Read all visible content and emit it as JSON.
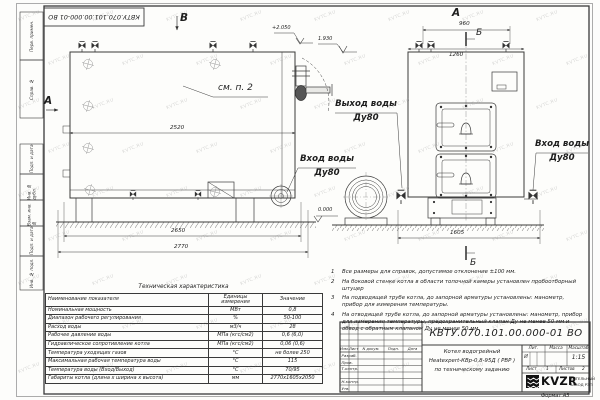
{
  "sheet": {
    "stamp_top": "КВТУ.070.101.00.000-01  ВО",
    "format_note": "Формат  А3",
    "watermark": "KVTC.RU",
    "side_labels": [
      "Перв. примен.",
      "Справ. №",
      "Подп. и дата",
      "Инв. № дубл.",
      "Взам. инв. №",
      "Подп. и дата",
      "Инв. № подл."
    ]
  },
  "views": {
    "side": {
      "view_mark_top": "В",
      "view_mark_left": "А",
      "see_note": "см. п. 2",
      "elev_top": "+2.050",
      "elev_outlet": "1.930",
      "elev_zero": "0.000",
      "dim_body": "2520",
      "dim_mid": "2650",
      "dim_overall": "2770",
      "outlet_line1": "Выход воды",
      "outlet_line2": "Ду80",
      "inlet_line1": "Вход воды",
      "inlet_line2": "Ду80"
    },
    "front": {
      "view_mark": "А",
      "section_mark_top": "Б",
      "section_mark_bottom": "Б",
      "dim_top": "960",
      "dim_body": "1260",
      "dim_base": "1605",
      "inlet_line1": "Вход воды",
      "inlet_line2": "Ду80"
    }
  },
  "notes": [
    {
      "num": "1",
      "text": "Все размеры для справок, допустимое отклонение ±100 мм."
    },
    {
      "num": "2",
      "text": "На боковой стенке котла в области топочной камеры установлен пробоотборный штуцер"
    },
    {
      "num": "3",
      "text": "На подводящей трубе котла, до запорной арматуры установлены: манометр, прибор для измерения температуры."
    },
    {
      "num": "4",
      "text": "На отводящей трубе котла, до запорной арматуры установлены: манометр, прибор для измерения температуры, предохранительный клапан Ду не менее 50 мм и обвод с обратным клапаном Ду не менее 50 мм."
    }
  ],
  "spec_table": {
    "title": "Техническая характеристика",
    "col_name": "Наименование показателя",
    "col_units": "Единицы измерения",
    "col_value": "Значение",
    "rows": [
      [
        "Номинальная мощность",
        "МВт",
        "0,8"
      ],
      [
        "Диапазон рабочего регулирования",
        "%",
        "50-100"
      ],
      [
        "Расход воды",
        "м3/ч",
        "28"
      ],
      [
        "Рабочее давление воды",
        "МПа (кгс/см2)",
        "0,6 (6,0)"
      ],
      [
        "Гидравлическое сопротивление котла",
        "МПа (кгс/см2)",
        "0,06 (0,6)"
      ],
      [
        "Температура уходящих газов",
        "°С",
        "не более 250"
      ],
      [
        "Максимальная рабочая температура воды",
        "°С",
        "115"
      ],
      [
        "Температура воды (Вход/Выход)",
        "°С",
        "70/95"
      ],
      [
        "Габариты котла (длина х ширина х высота)",
        "мм",
        "2770х1605х2050"
      ]
    ]
  },
  "title_block": {
    "doc_number": "КВТУ.070.101.00.000-01  ВО",
    "name_line1": "Котел водогрейный",
    "name_line2": "Heatexpert-КВр-0,8-95Д ( РВР )",
    "name_line3": "по техническому заданию",
    "rev_cols": [
      "Изм.",
      "Лист",
      "N докум.",
      "Подп.",
      "Дата"
    ],
    "roles": [
      "Разраб.",
      "Пров.",
      "Т.контр.",
      "",
      "Н.контр.",
      "Утв."
    ],
    "lit_label": "Лит.",
    "mass_label": "Масса",
    "scale_label": "Масштаб",
    "lit_value": "И",
    "scale_value": "1:15",
    "sheet_label": "Лист",
    "sheet_value": "1",
    "sheets_label": "Листов",
    "sheets_value": "2",
    "logo_text": "KVZR",
    "logo_sub1": "КОТЕЛЬНЫЙ",
    "logo_sub2": "ЗАВОД РЭП"
  },
  "colors": {
    "line": "#3a3a3a",
    "paper": "#fdfdfb"
  }
}
